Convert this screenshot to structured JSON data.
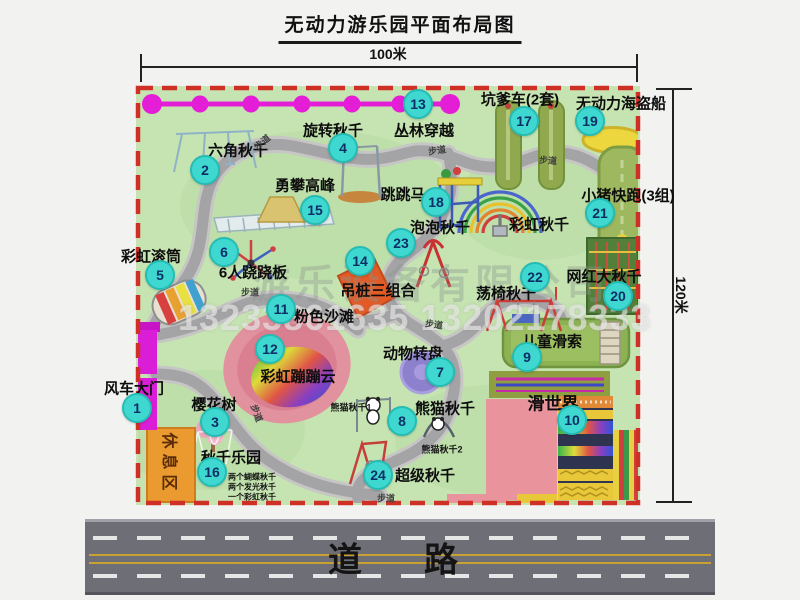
{
  "title": "无动力游乐园平面布局图",
  "dimensions": {
    "width_label": "100米",
    "height_label": "120米"
  },
  "road": {
    "label": "道　路"
  },
  "watermarks": {
    "company": "游乐设备有限公司",
    "phones": "13233861635 13202178333"
  },
  "colors": {
    "park_green": "#c6e4b2",
    "border_red": "#cf3026",
    "road_gray": "#6e6e76",
    "marker_teal": "#3ed8d0",
    "gate_magenta": "#da1ed8",
    "zipline_magenta": "#e41ed6",
    "rest_area_orange": "#ea9a2e",
    "pirate_ship_yellow": "#ecd83e"
  },
  "markers": [
    {
      "n": "1",
      "x": 137,
      "y": 408
    },
    {
      "n": "2",
      "x": 205,
      "y": 170
    },
    {
      "n": "3",
      "x": 215,
      "y": 422
    },
    {
      "n": "4",
      "x": 343,
      "y": 148
    },
    {
      "n": "5",
      "x": 160,
      "y": 275
    },
    {
      "n": "6",
      "x": 224,
      "y": 252
    },
    {
      "n": "7",
      "x": 440,
      "y": 372
    },
    {
      "n": "8",
      "x": 402,
      "y": 421
    },
    {
      "n": "9",
      "x": 527,
      "y": 357
    },
    {
      "n": "10",
      "x": 572,
      "y": 420
    },
    {
      "n": "11",
      "x": 281,
      "y": 309
    },
    {
      "n": "12",
      "x": 270,
      "y": 349
    },
    {
      "n": "13",
      "x": 418,
      "y": 104
    },
    {
      "n": "14",
      "x": 360,
      "y": 261
    },
    {
      "n": "15",
      "x": 315,
      "y": 210
    },
    {
      "n": "16",
      "x": 212,
      "y": 472
    },
    {
      "n": "17",
      "x": 524,
      "y": 121
    },
    {
      "n": "18",
      "x": 436,
      "y": 202
    },
    {
      "n": "19",
      "x": 590,
      "y": 121
    },
    {
      "n": "20",
      "x": 618,
      "y": 296
    },
    {
      "n": "21",
      "x": 600,
      "y": 213
    },
    {
      "n": "22",
      "x": 535,
      "y": 277
    },
    {
      "n": "23",
      "x": 401,
      "y": 243
    },
    {
      "n": "24",
      "x": 378,
      "y": 475
    }
  ],
  "labels": [
    {
      "t": "风车大门",
      "x": 134,
      "y": 388
    },
    {
      "t": "六角秋千",
      "x": 238,
      "y": 150
    },
    {
      "t": "樱花树",
      "x": 214,
      "y": 404
    },
    {
      "t": "旋转秋千",
      "x": 333,
      "y": 130
    },
    {
      "t": "彩虹滚筒",
      "x": 151,
      "y": 256
    },
    {
      "t": "6人跷跷板",
      "x": 253,
      "y": 272
    },
    {
      "t": "动物转盘",
      "x": 413,
      "y": 353
    },
    {
      "t": "熊猫秋千",
      "x": 445,
      "y": 408
    },
    {
      "t": "熊猫秋千1",
      "x": 351,
      "y": 407,
      "size": 9,
      "cls": "sub"
    },
    {
      "t": "熊猫秋千2",
      "x": 442,
      "y": 449,
      "size": 9,
      "cls": "sub"
    },
    {
      "t": "儿童滑索",
      "x": 552,
      "y": 341
    },
    {
      "t": "滑世界",
      "x": 553,
      "y": 402,
      "size": 17
    },
    {
      "t": "粉色沙滩",
      "x": 324,
      "y": 316
    },
    {
      "t": "彩虹蹦蹦云",
      "x": 298,
      "y": 376
    },
    {
      "t": "丛林穿越",
      "x": 424,
      "y": 130
    },
    {
      "t": "吊桩三组合",
      "x": 378,
      "y": 290
    },
    {
      "t": "勇攀高峰",
      "x": 305,
      "y": 185
    },
    {
      "t": "秋千乐园",
      "x": 231,
      "y": 457
    },
    {
      "t": "两个蝴蝶秋千",
      "x": 252,
      "y": 477,
      "size": 8,
      "cls": "sub"
    },
    {
      "t": "两个发光秋千",
      "x": 252,
      "y": 487,
      "size": 8,
      "cls": "sub"
    },
    {
      "t": "一个彩虹秋千",
      "x": 252,
      "y": 497,
      "size": 8,
      "cls": "sub"
    },
    {
      "t": "坑爹车(2套)",
      "x": 520,
      "y": 99
    },
    {
      "t": "跳跳马",
      "x": 403,
      "y": 194
    },
    {
      "t": "无动力海盗船",
      "x": 621,
      "y": 103
    },
    {
      "t": "网红大秋千",
      "x": 604,
      "y": 276
    },
    {
      "t": "小猪快跑(3组)",
      "x": 628,
      "y": 195
    },
    {
      "t": "荡椅秋千",
      "x": 506,
      "y": 293
    },
    {
      "t": "泡泡秋千",
      "x": 440,
      "y": 227
    },
    {
      "t": "超级秋千",
      "x": 425,
      "y": 475
    },
    {
      "t": "彩虹秋千",
      "x": 539,
      "y": 224
    },
    {
      "t": "休息区",
      "x": 171,
      "y": 464,
      "size": 16,
      "rotate": 90,
      "cls": "rest"
    },
    {
      "t": "步道",
      "x": 262,
      "y": 142,
      "size": 9,
      "rotate": -40,
      "cls": "path"
    },
    {
      "t": "步道",
      "x": 437,
      "y": 150,
      "size": 9,
      "rotate": -8,
      "cls": "path"
    },
    {
      "t": "步道",
      "x": 548,
      "y": 160,
      "size": 9,
      "rotate": 4,
      "cls": "path"
    },
    {
      "t": "步道",
      "x": 250,
      "y": 292,
      "size": 9,
      "cls": "path"
    },
    {
      "t": "步道",
      "x": 257,
      "y": 413,
      "size": 9,
      "rotate": 70,
      "cls": "path"
    },
    {
      "t": "步道",
      "x": 434,
      "y": 324,
      "size": 9,
      "rotate": 8,
      "cls": "path"
    },
    {
      "t": "步道",
      "x": 386,
      "y": 498,
      "size": 9,
      "cls": "path"
    }
  ]
}
